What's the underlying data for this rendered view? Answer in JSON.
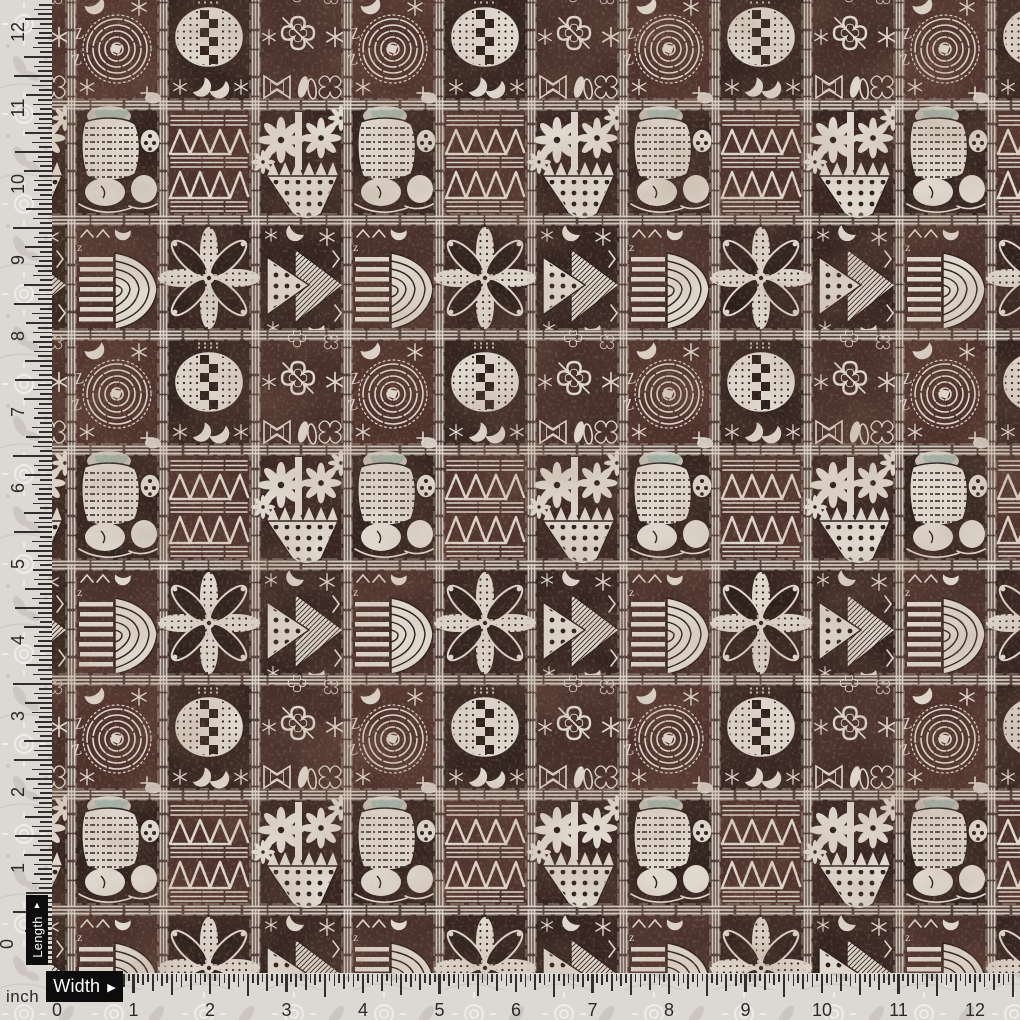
{
  "meta": {
    "description": "Scanned swatch of African tapa/adinkra style block-print fabric in dark brown and off-white, shown with inch rulers along the left (length) and bottom (width) edges over a pale damask backing fabric"
  },
  "colors": {
    "backing": "#dcd8d4",
    "backing_motif": "#c7c1bc",
    "backing_light": "#f1eeea",
    "fabric_base": "#3a231e",
    "fabric_dark": "#241511",
    "fabric_red": "#5b342a",
    "motif_white": "#e9e1d6",
    "motif_dim": "#bfb3a8",
    "teal_accent": "#9fb6ab",
    "ruler_ink": "#1e1d1b",
    "number_ink": "#2c2a28",
    "label_bg": "#0c0c0c",
    "label_fg": "#ffffff"
  },
  "rulers": {
    "unit_label": "inch",
    "left": {
      "numbers": [
        "0",
        "1",
        "2",
        "3",
        "4",
        "5",
        "6",
        "7",
        "8",
        "9",
        "10",
        "11",
        "12"
      ],
      "zero_px": 950,
      "px_per_inch": 76,
      "tick_base": 52,
      "range_px": [
        2,
        966
      ],
      "tick_lengths": {
        "inch": 18,
        "half": 38,
        "quarter": 27,
        "eighth": 19,
        "sixteenth": 13
      }
    },
    "bottom": {
      "numbers": [
        "0",
        "1",
        "2",
        "3",
        "4",
        "5",
        "6",
        "7",
        "8",
        "9",
        "10",
        "11",
        "12"
      ],
      "zero_px": 57,
      "px_per_inch": 76.5,
      "tick_base": 974,
      "range_px": [
        46,
        1016
      ],
      "tick_lengths": {
        "inch": 19,
        "half": 22,
        "quarter": 16,
        "eighth": 12,
        "sixteenth": 8
      }
    }
  },
  "labels": {
    "length": {
      "text": "Length",
      "arrow_glyph": "▲"
    },
    "width": {
      "text": "Width",
      "arrow_glyph": "▶"
    }
  },
  "fabric": {
    "motifs": [
      "spiral",
      "dotted-oval-checker",
      "cross-flowers",
      "fish-collage",
      "triangle-lattice",
      "flower-basket",
      "stripe-shell",
      "rosette",
      "dotted-pennant"
    ]
  }
}
